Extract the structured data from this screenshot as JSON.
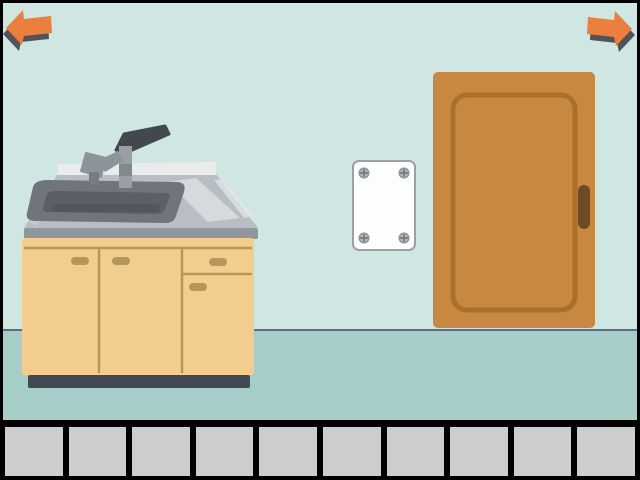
{
  "scene": {
    "name": "escape-room-kitchen",
    "objects": [
      {
        "name": "kitchen-sink-cabinet",
        "description_icon": "sink-icon"
      },
      {
        "name": "wall-sign",
        "description_icon": "blank-plate-icon",
        "screw_count": 4
      },
      {
        "name": "door",
        "description_icon": "door-icon"
      }
    ]
  },
  "navigation": {
    "prev": {
      "icon": "arrow-left"
    },
    "next": {
      "icon": "arrow-right"
    }
  },
  "inventory": {
    "slot_count": 10,
    "slots": [
      "",
      "",
      "",
      "",
      "",
      "",
      "",
      "",
      "",
      ""
    ]
  },
  "colors": {
    "frame": "#000000",
    "wall": "#cfe6e2",
    "floor": "#a6cdc7",
    "floor-line": "#5e6b82",
    "arrow": "#ec7f3e",
    "arrow-shadow": "#2e3036",
    "door-body": "#c8883f",
    "door-panel-line": "#a66d2a",
    "door-handle": "#6f4b24",
    "sign-bg": "#fdfdfd",
    "sign-border": "#9ba1a5",
    "screw": "#aeb4b8",
    "screw-line": "#6c7276",
    "backsplash": "#e9eceb",
    "counter-top": "#b8bec3",
    "counter-front": "#8f969c",
    "counter-highlight": "#dadfe2",
    "basin-outer": "#6f757b",
    "basin-inner": "#5a6066",
    "basin-shade": "#4e545a",
    "cabinet": "#f3cd8d",
    "cabinet-line": "#b6975a",
    "cabinet-base": "#434857",
    "faucet-metal": "#98a0a5",
    "faucet-dark": "#42484e",
    "spout-metal": "#8d9499",
    "inventory-bar": "#000000",
    "inventory-slot": "#cdcdcd"
  }
}
